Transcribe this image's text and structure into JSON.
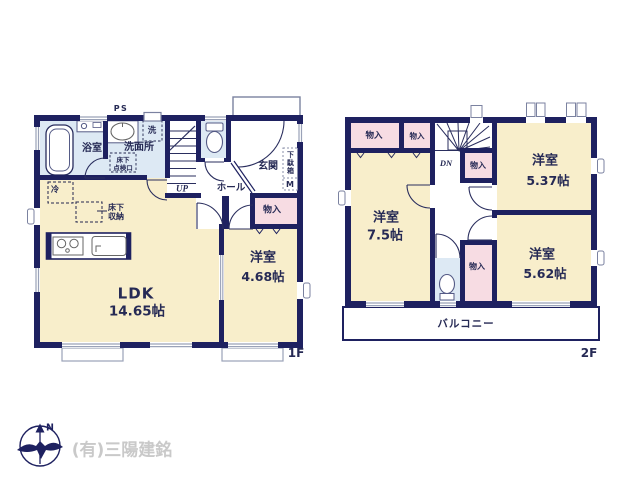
{
  "watermark": "(有)三陽建銘",
  "compass": {
    "north_label": "N"
  },
  "floor1": {
    "floor_label": "1F",
    "rooms": {
      "bath": "浴室",
      "washroom": "洗面所",
      "ldk_name": "LDK",
      "ldk_size": "14.65帖",
      "bedroom_name": "洋室",
      "bedroom_size": "4.68帖",
      "hall": "ホール",
      "entrance": "玄関"
    },
    "fixtures": {
      "ps": "PS",
      "washer": "洗",
      "fridge": "冷",
      "underfloor_hatch_line1": "床下",
      "underfloor_hatch_line2": "点検口",
      "underfloor_storage_line1": "床下",
      "underfloor_storage_line2": "収納",
      "closet": "物入",
      "shoe_cabinet": "下駄箱",
      "meter": "M",
      "stairs_up": "UP"
    }
  },
  "floor2": {
    "floor_label": "2F",
    "rooms": {
      "bedroom_a_name": "洋室",
      "bedroom_a_size": "7.5帖",
      "bedroom_b_name": "洋室",
      "bedroom_b_size": "5.37帖",
      "bedroom_c_name": "洋室",
      "bedroom_c_size": "5.62帖",
      "balcony": "バルコニー"
    },
    "fixtures": {
      "closet_a": "物入",
      "closet_b": "物入",
      "closet_c": "物入",
      "closet_d": "物入",
      "stairs_down": "DN"
    }
  }
}
